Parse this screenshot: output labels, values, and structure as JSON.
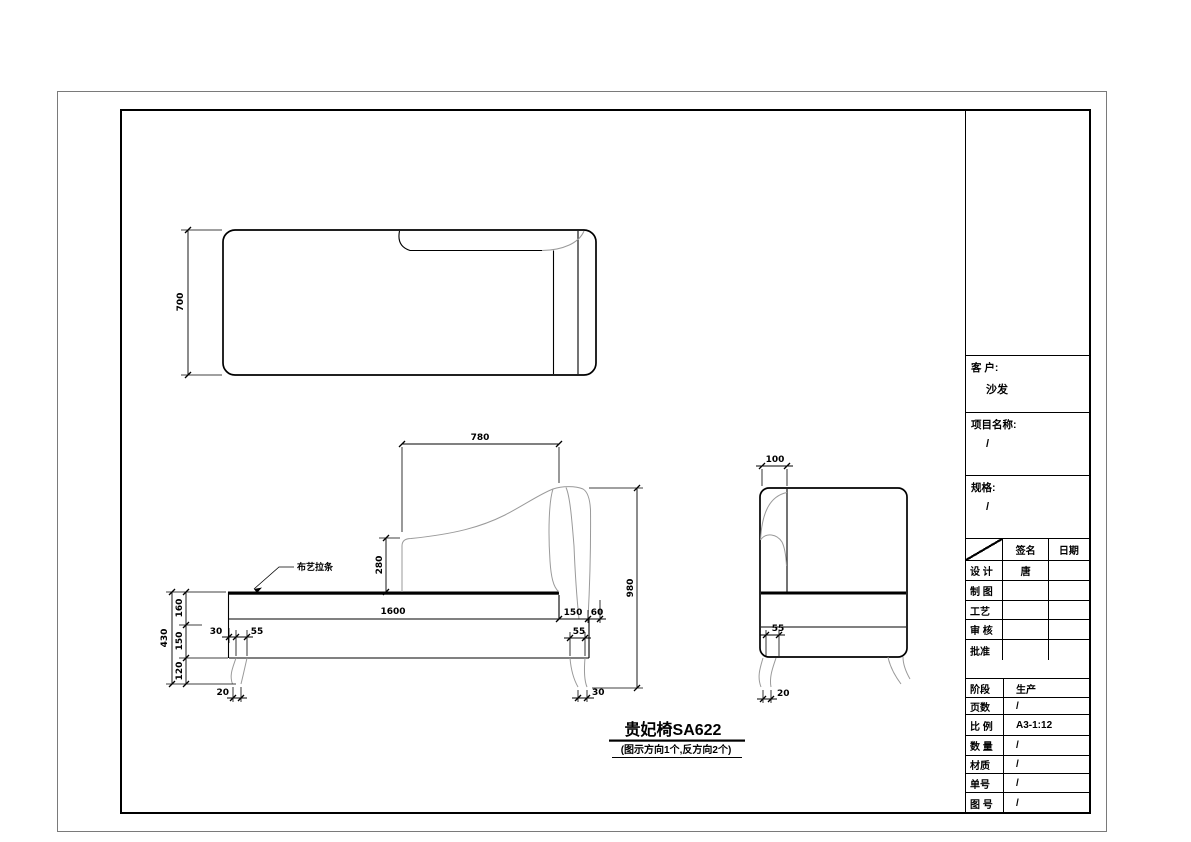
{
  "caption": {
    "title": "贵妃椅SA622",
    "note": "(图示方向1个,反方向2个)"
  },
  "dims": {
    "top_depth": "700",
    "back_width": "780",
    "back_rise": "280",
    "piping_label": "布艺拉条",
    "overall_height_left": "430",
    "seat_band": "160",
    "rail_height": "150",
    "leg_height": "120",
    "seat_length": "1600",
    "leg_inset": "30",
    "leg_width": "55",
    "leg_tip": "20",
    "back_depth": "150",
    "back_overhang": "60",
    "right_leg_width": "55",
    "right_leg_tip": "30",
    "overall_height": "980",
    "side_back_thickness": "100",
    "side_leg_width": "55",
    "side_leg_tip": "20"
  },
  "title_block": {
    "customer_label": "客 户:",
    "customer_value": "沙发",
    "project_label": "项目名称:",
    "project_value": "/",
    "spec_label": "规格:",
    "spec_value": "/",
    "sign_header": {
      "signature": "签名",
      "date": "日期"
    },
    "sign_rows": [
      {
        "label": "设 计",
        "signature": "唐",
        "date": ""
      },
      {
        "label": "制 图",
        "signature": "",
        "date": ""
      },
      {
        "label": "工艺",
        "signature": "",
        "date": ""
      },
      {
        "label": "审 核",
        "signature": "",
        "date": ""
      },
      {
        "label": "批准",
        "signature": "",
        "date": ""
      }
    ],
    "info_rows": [
      {
        "label": "阶段",
        "value": "生产"
      },
      {
        "label": "页数",
        "value": "/"
      },
      {
        "label": "比 例",
        "value": "A3-1:12"
      },
      {
        "label": "数 量",
        "value": "/"
      },
      {
        "label": "材质",
        "value": "/"
      },
      {
        "label": "单号",
        "value": "/"
      },
      {
        "label": "图 号",
        "value": "/"
      }
    ]
  }
}
